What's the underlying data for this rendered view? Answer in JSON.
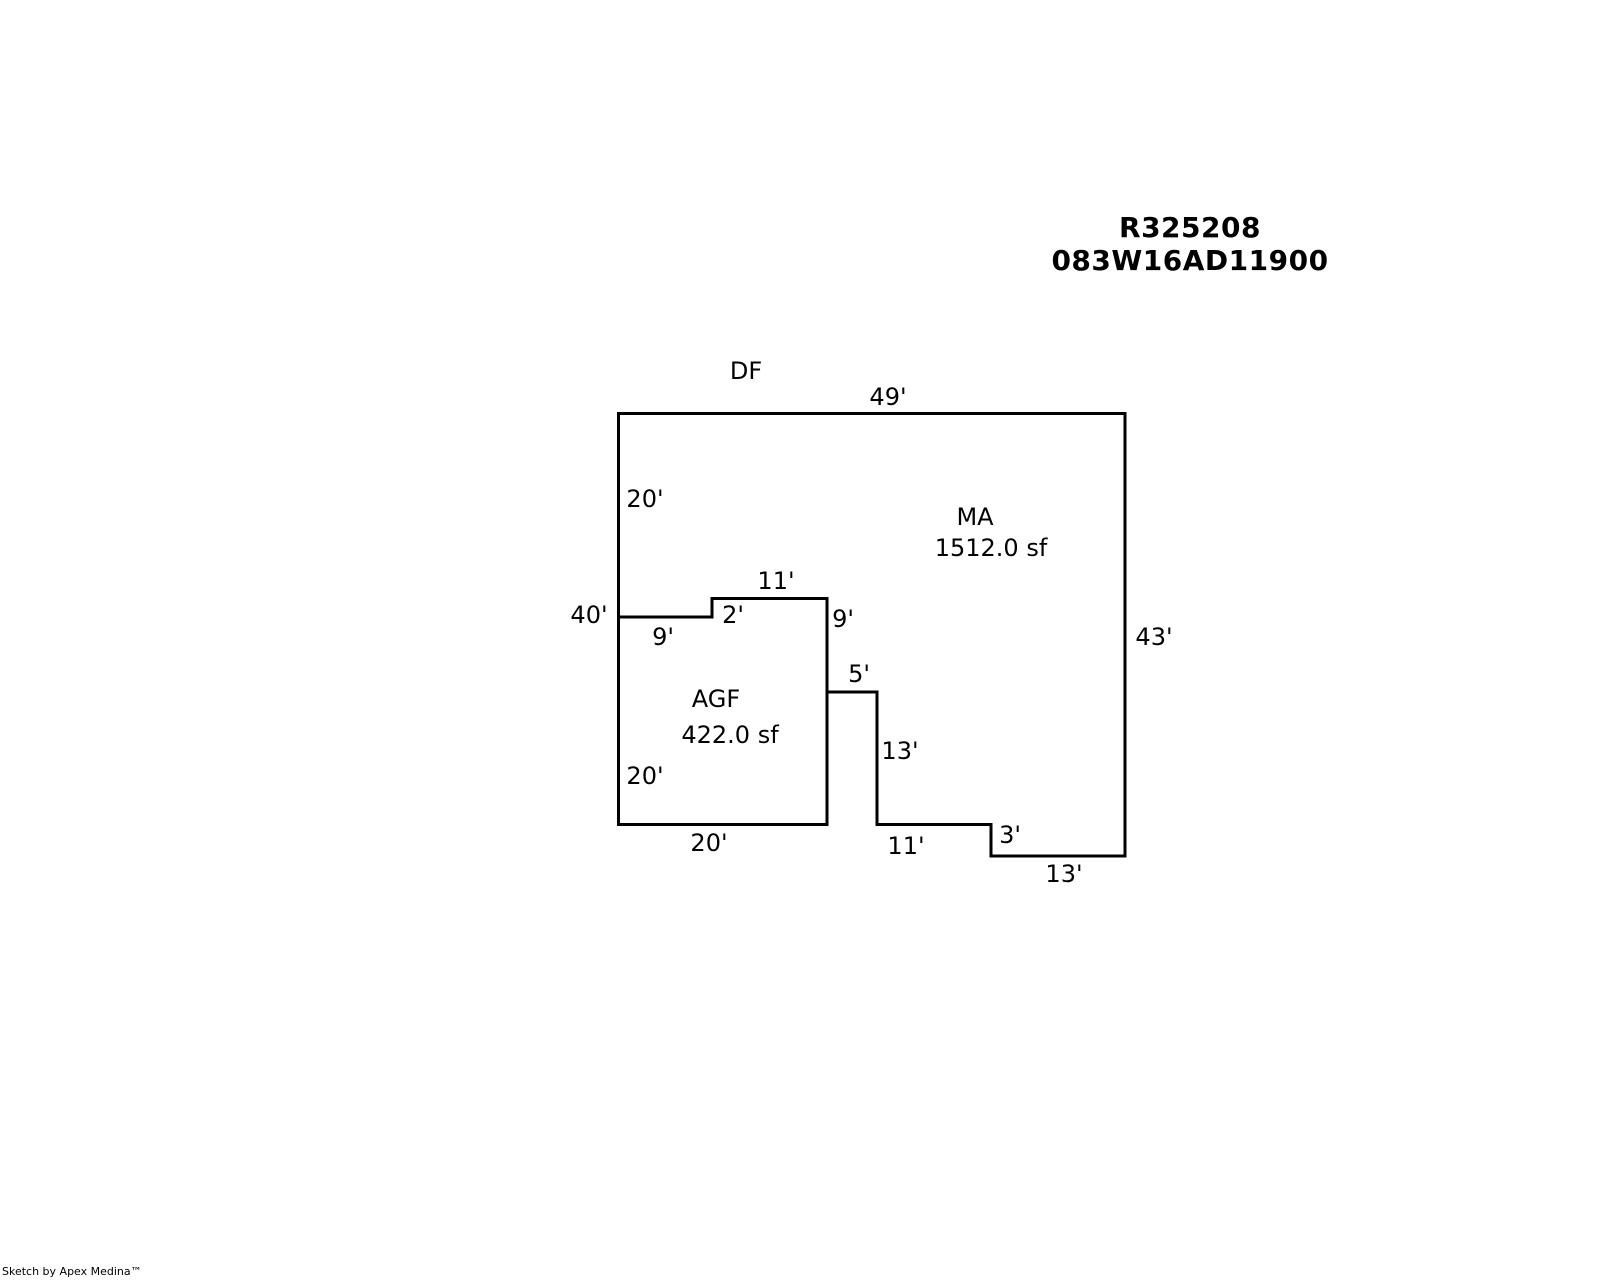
{
  "title": {
    "line1": "R325208",
    "line2": "083W16AD11900"
  },
  "plan": {
    "df_label": "DF",
    "ma": {
      "code": "MA",
      "area": "1512.0 sf",
      "area_value": 1512.0
    },
    "agf": {
      "code": "AGF",
      "area": "422.0 sf",
      "area_value": 422.0
    },
    "line_color": "#000000",
    "dims": {
      "top": "49'",
      "left_upper": "20'",
      "left_total": "40'",
      "notch_top": "11'",
      "notch_step": "2'",
      "notch_right": "9'",
      "notch_bottom": "9'",
      "step_right": "5'",
      "right": "43'",
      "mid_right": "13'",
      "agf_left": "20'",
      "agf_bottom": "20'",
      "bottom_left": "11'",
      "bottom_step": "3'",
      "bottom_right": "13'"
    }
  },
  "footer": {
    "credit": "Sketch by Apex Medina™"
  }
}
